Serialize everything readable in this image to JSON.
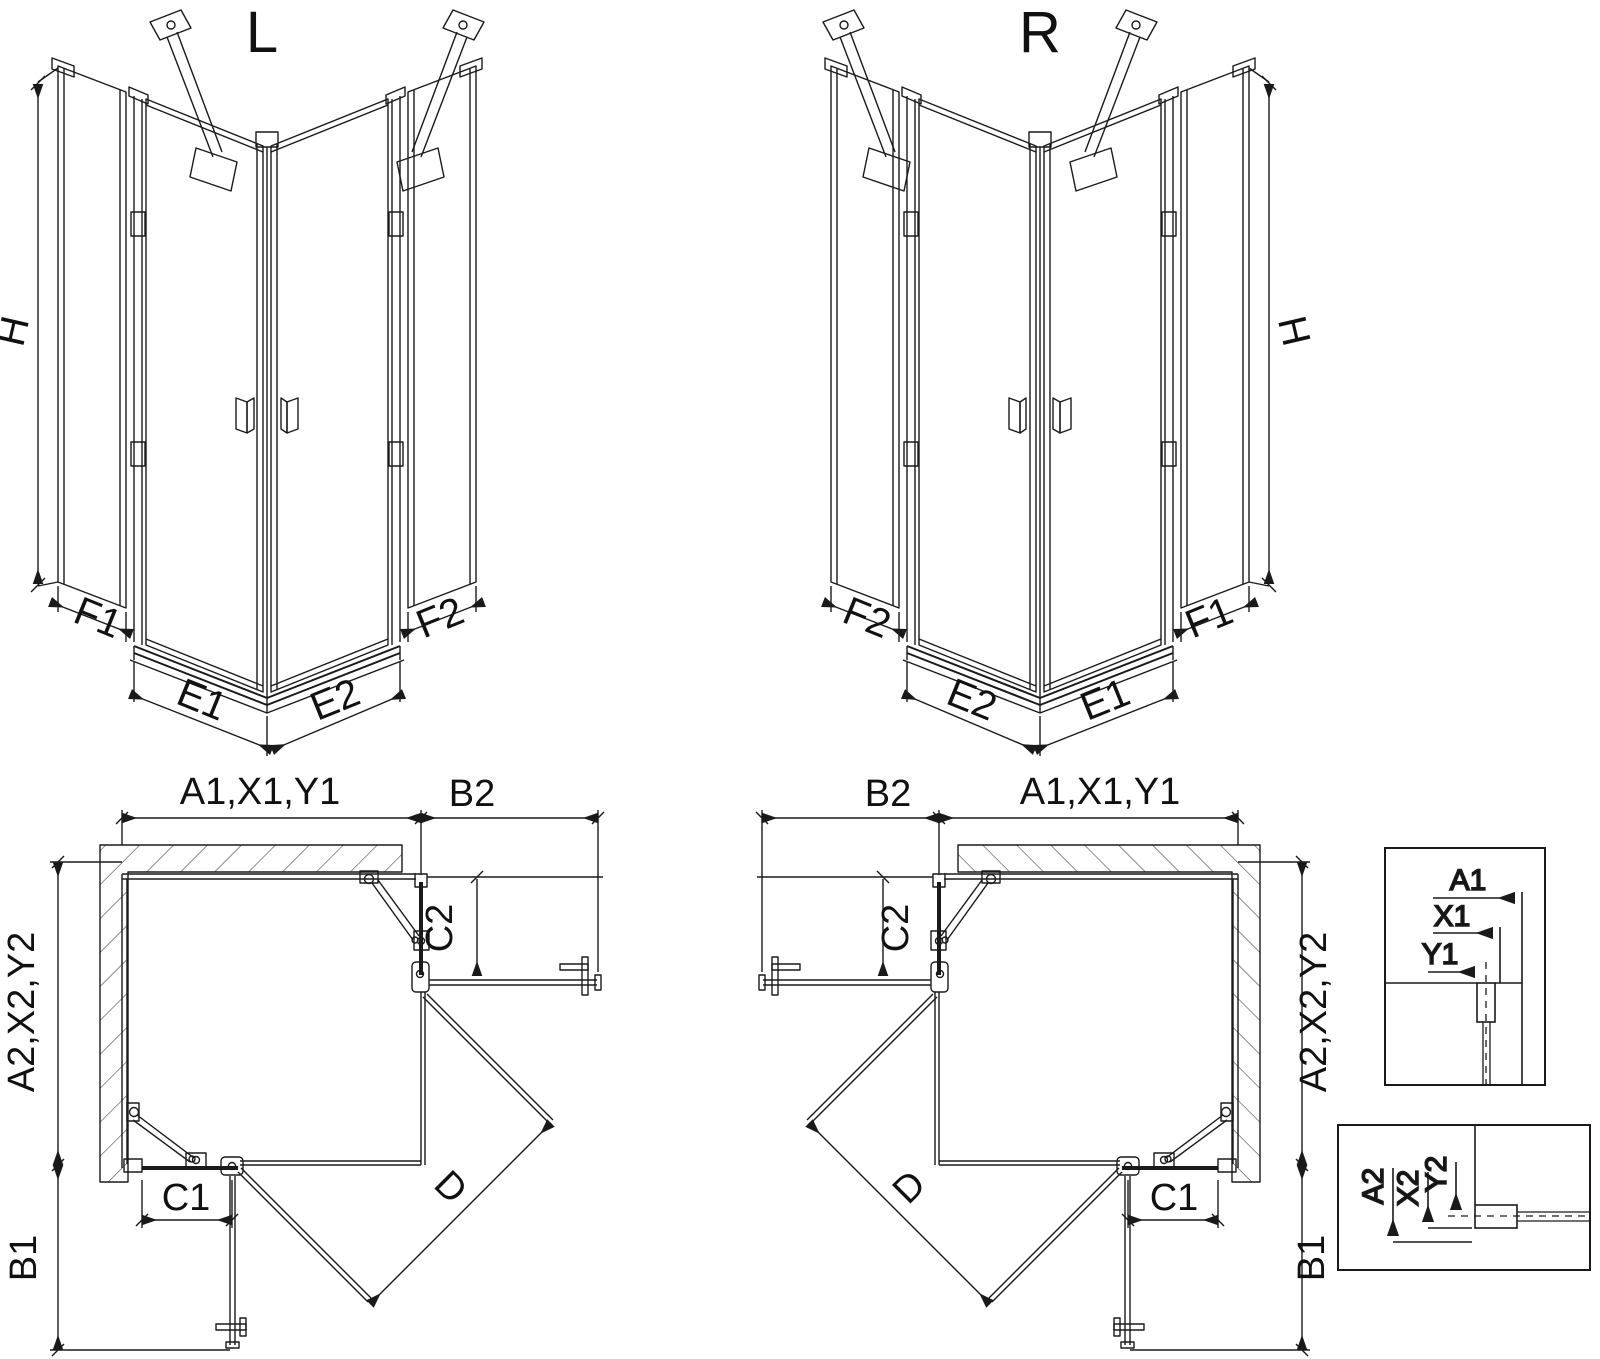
{
  "drawing": {
    "kind": "shower-enclosure-technical-drawing",
    "variants": {
      "left_title": "L",
      "right_title": "R"
    },
    "iso": {
      "h": "H",
      "f1": "F1",
      "e1": "E1",
      "e2": "E2",
      "f2": "F2"
    },
    "plan": {
      "top_width": "A1,X1,Y1",
      "side_clearance_top": "B2",
      "fixed_top": "C2",
      "side_depth": "A2,X2,Y2",
      "fixed_bottom": "C1",
      "side_clearance_bottom": "B1",
      "diagonal_entry": "D"
    },
    "detail_top": {
      "a1": "A1",
      "x1": "X1",
      "y1": "Y1"
    },
    "detail_bottom": {
      "a2": "A2",
      "x2": "X2",
      "y2": "Y2"
    },
    "colors": {
      "line": "#1a1a1a",
      "background": "#ffffff"
    }
  }
}
